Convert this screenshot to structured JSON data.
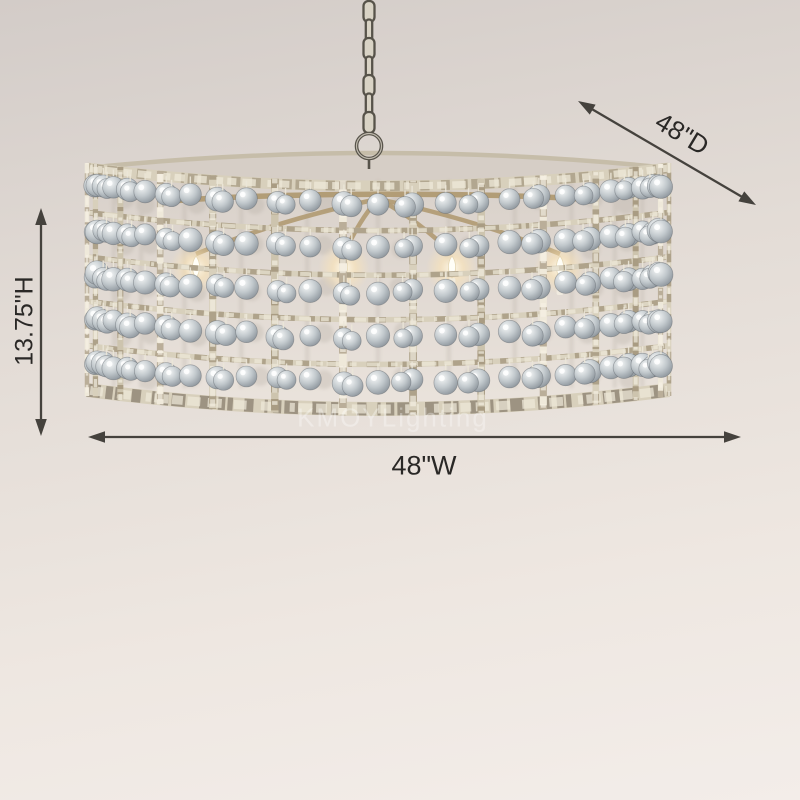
{
  "product_image": {
    "description": "Distressed silver-leaf iron drum chandelier with square grid frame, rows of glass crystal ball ornaments, lit candelabra bulbs inside, hanging from a metal chain",
    "background": {
      "top_color": "#d3ccc8",
      "upper_mid_color": "#e3dcd6",
      "lower_mid_color": "#eee7e1",
      "bottom_color": "#f3ede9"
    },
    "palette": {
      "metal_light": "#efe9da",
      "metal_mid": "#d8d0bc",
      "metal_alt": "#cdc4ae",
      "metal_dark": "#86755a",
      "metal_shadow": "#564a3b",
      "rim_back": "#c6bda9",
      "ball_light": "#f5f7f7",
      "ball_mid": "#c1c8cc",
      "ball_dark": "#8f979e",
      "ball_back": "#b4aca2",
      "interior_top": "#d8d0c9",
      "interior_bottom": "#eae3dc",
      "opening_fill": "#d6cec6",
      "arm_bronze": "#b09a72",
      "candle_white": "#f1ebdf",
      "flame_white": "#fffef7",
      "glow_warm": "#ffe6b4",
      "chain_fill": "#d9d3c5",
      "chain_outline": "#57534a"
    },
    "structure": {
      "ball_rows": 5,
      "grid_columns": 13,
      "lit_bulbs": 4,
      "chain_links": 7
    }
  },
  "dimensions": {
    "arrow_color": "#45423d",
    "label_color": "#2a2826",
    "depth_label": "48\"D",
    "height_label": "13.75\"H",
    "width_label": "48\"W"
  },
  "watermark": {
    "text": "KMOYLighting",
    "color": "rgba(255,255,255,0.32)"
  }
}
